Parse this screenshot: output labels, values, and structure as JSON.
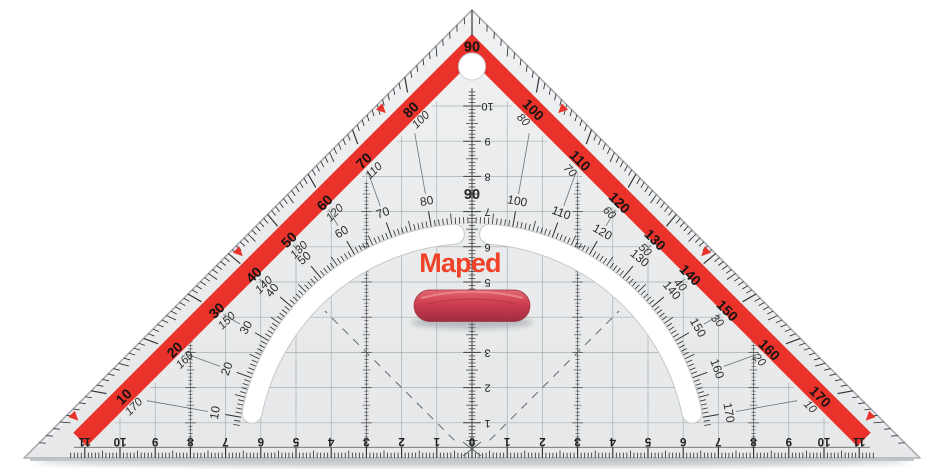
{
  "scene": {
    "description": "Maped Technic 45-degree geometry set square (Geodreieck) with red protractor band, inner degree arc, grip handle and centimetre rulers",
    "background": "#ffffff"
  },
  "brand": {
    "name": "Maped",
    "color": "#f04228"
  },
  "colors": {
    "body": "#e9ebec",
    "band_red": "#e8322a",
    "handle_red": "#c43b4d",
    "tick_dark": "#2b2d2f",
    "grid_gray": "#9aa0a5",
    "slot_rim": "#c5c9cc",
    "shadow": "#b7bbbe",
    "outline": "#abafb3",
    "number_black": "#1c1d1e"
  },
  "protractor": {
    "apex_label": "90",
    "left_edge_main": [
      "10",
      "20",
      "30",
      "40",
      "50",
      "60",
      "70",
      "80"
    ],
    "right_edge_main": [
      "100",
      "110",
      "120",
      "130",
      "140",
      "150",
      "160",
      "170"
    ],
    "left_edge_reverse": [
      "170",
      "160",
      "150",
      "140",
      "130",
      "120",
      "110",
      "100"
    ],
    "right_edge_reverse": [
      "80",
      "70",
      "60",
      "50",
      "40",
      "30",
      "20",
      "10"
    ],
    "arc_labels": [
      "10",
      "20",
      "30",
      "40",
      "50",
      "60",
      "70",
      "80",
      "90",
      "100",
      "110",
      "120",
      "130",
      "140",
      "150",
      "160",
      "170"
    ],
    "arc_bold_label": "90"
  },
  "vertical_ruler": {
    "unit": "cm",
    "labels": [
      "1",
      "2",
      "3",
      "4",
      "5",
      "6",
      "7",
      "8",
      "9",
      "10"
    ]
  },
  "bottom_ruler": {
    "unit": "cm",
    "left": [
      "11",
      "10",
      "9",
      "8",
      "7",
      "6",
      "5",
      "4",
      "3",
      "2",
      "1"
    ],
    "zero": "0",
    "right": [
      "1",
      "2",
      "3",
      "4",
      "5",
      "6",
      "7",
      "8",
      "9",
      "10",
      "11"
    ]
  }
}
